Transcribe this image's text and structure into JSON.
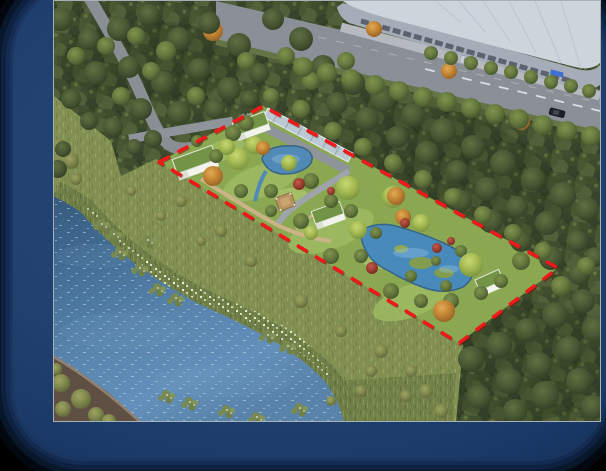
{
  "scene": {
    "description": "Aerial perspective rendering of a riverside wetland park: red dashed site boundary enclosing lawns, two ponds, four small white flat-roof buildings, a gazebo and a glass corridor; dense forest around, a river with lily pads on the lower left, and a commercial street with a large retail building and street trees at the upper right",
    "boundary": {
      "color": "#f01112",
      "style": "dashed",
      "corners": "158,161 262,105 557,267 458,342"
    },
    "colors": {
      "frame_navy": "#1f3e70",
      "background": "#000000",
      "river_water": "#527fa9",
      "pond_water": "#4286b8",
      "site_lawn": "#87a54c",
      "forest_canopy": "#2c3a20",
      "road_asphalt": "#878c94",
      "building_roof_gray": "#ccd3db",
      "park_building_white": "#f1f3ec",
      "park_building_roof_green": "#6f9040",
      "gazebo_roof_tan": "#b5905c",
      "shore_flowers": "#eef2e4"
    },
    "inventory": {
      "white_park_buildings": 4,
      "gazebo": 1,
      "ponds": 2,
      "cars_on_road": 2,
      "commercial_building": 1
    },
    "trees": {
      "forest_dark": [
        [
          60,
          18,
          12
        ],
        [
          88,
          38,
          11
        ],
        [
          118,
          28,
          12
        ],
        [
          148,
          14,
          11
        ],
        [
          178,
          38,
          12
        ],
        [
          208,
          22,
          11
        ],
        [
          238,
          44,
          12
        ],
        [
          272,
          18,
          11
        ],
        [
          300,
          38,
          12
        ],
        [
          95,
          72,
          12
        ],
        [
          70,
          98,
          10
        ],
        [
          128,
          66,
          11
        ],
        [
          162,
          82,
          12
        ],
        [
          198,
          68,
          11
        ],
        [
          228,
          88,
          12
        ],
        [
          258,
          72,
          10
        ],
        [
          140,
          108,
          11
        ],
        [
          178,
          112,
          12
        ],
        [
          214,
          108,
          10
        ],
        [
          112,
          126,
          10
        ],
        [
          88,
          120,
          9
        ],
        [
          248,
          98,
          9
        ],
        [
          152,
          138,
          9
        ],
        [
          133,
          146,
          8
        ],
        [
          57,
          168,
          9
        ],
        [
          62,
          148,
          8
        ],
        [
          322,
          66,
          12
        ],
        [
          352,
          82,
          12
        ],
        [
          382,
          98,
          13
        ],
        [
          412,
          114,
          12
        ],
        [
          442,
          130,
          13
        ],
        [
          472,
          146,
          12
        ],
        [
          502,
          162,
          13
        ],
        [
          532,
          178,
          12
        ],
        [
          562,
          194,
          13
        ],
        [
          586,
          208,
          12
        ],
        [
          336,
          102,
          11
        ],
        [
          366,
          118,
          12
        ],
        [
          396,
          136,
          11
        ],
        [
          426,
          152,
          12
        ],
        [
          456,
          170,
          11
        ],
        [
          486,
          188,
          12
        ],
        [
          516,
          206,
          11
        ],
        [
          546,
          222,
          12
        ],
        [
          576,
          240,
          11
        ],
        [
          594,
          256,
          10
        ],
        [
          460,
          200,
          11
        ],
        [
          490,
          220,
          12
        ],
        [
          520,
          240,
          11
        ],
        [
          550,
          257,
          12
        ],
        [
          578,
          273,
          11
        ],
        [
          470,
          358,
          13
        ],
        [
          498,
          344,
          13
        ],
        [
          526,
          329,
          12
        ],
        [
          554,
          314,
          13
        ],
        [
          582,
          300,
          12
        ],
        [
          594,
          328,
          13
        ],
        [
          568,
          348,
          13
        ],
        [
          538,
          364,
          13
        ],
        [
          508,
          380,
          13
        ],
        [
          478,
          396,
          12
        ],
        [
          544,
          394,
          14
        ],
        [
          578,
          380,
          13
        ],
        [
          592,
          406,
          12
        ],
        [
          514,
          410,
          12
        ]
      ],
      "forest_mid": [
        [
          75,
          55,
          9
        ],
        [
          105,
          45,
          9
        ],
        [
          165,
          50,
          10
        ],
        [
          195,
          95,
          9
        ],
        [
          245,
          60,
          9
        ],
        [
          285,
          55,
          9
        ],
        [
          120,
          95,
          9
        ],
        [
          310,
          80,
          9
        ],
        [
          345,
          60,
          9
        ],
        [
          150,
          70,
          9
        ],
        [
          135,
          35,
          9
        ],
        [
          332,
          130,
          9
        ],
        [
          362,
          146,
          9
        ],
        [
          392,
          162,
          9
        ],
        [
          422,
          178,
          9
        ],
        [
          452,
          196,
          9
        ],
        [
          482,
          214,
          9
        ],
        [
          512,
          232,
          9
        ],
        [
          542,
          250,
          9
        ],
        [
          300,
          108,
          9
        ],
        [
          270,
          95,
          8
        ],
        [
          245,
          122,
          8
        ],
        [
          560,
          285,
          10
        ],
        [
          585,
          265,
          9
        ],
        [
          520,
          260,
          9
        ]
      ],
      "site_green": [
        [
          232,
          132,
          8
        ],
        [
          270,
          190,
          7
        ],
        [
          310,
          180,
          8
        ],
        [
          330,
          200,
          7
        ],
        [
          300,
          220,
          8
        ],
        [
          330,
          255,
          8
        ],
        [
          360,
          255,
          7
        ],
        [
          390,
          290,
          8
        ],
        [
          420,
          300,
          7
        ],
        [
          450,
          300,
          8
        ],
        [
          480,
          292,
          7
        ],
        [
          270,
          210,
          6
        ],
        [
          240,
          190,
          7
        ],
        [
          215,
          155,
          7
        ],
        [
          196,
          140,
          6
        ],
        [
          350,
          210,
          7
        ],
        [
          445,
          285,
          6
        ],
        [
          500,
          280,
          7
        ],
        [
          375,
          232,
          6
        ],
        [
          410,
          275,
          6
        ],
        [
          435,
          260,
          5
        ],
        [
          460,
          250,
          6
        ]
      ],
      "willow": [
        [
          237,
          158,
          11
        ],
        [
          253,
          144,
          9
        ],
        [
          347,
          187,
          12
        ],
        [
          392,
          196,
          11
        ],
        [
          470,
          264,
          12
        ],
        [
          357,
          229,
          9
        ],
        [
          420,
          222,
          9
        ],
        [
          310,
          232,
          7
        ],
        [
          288,
          162,
          8
        ],
        [
          226,
          146,
          8
        ]
      ],
      "orange": [
        [
          212,
          30,
          10
        ],
        [
          448,
          70,
          8
        ],
        [
          373,
          28,
          8
        ],
        [
          395,
          195,
          9
        ],
        [
          212,
          175,
          10
        ],
        [
          443,
          310,
          11
        ],
        [
          402,
          216,
          8
        ],
        [
          262,
          147,
          7
        ],
        [
          520,
          120,
          9
        ]
      ],
      "red_shrub": [
        [
          298,
          183,
          6
        ],
        [
          371,
          267,
          6
        ],
        [
          436,
          247,
          5
        ],
        [
          450,
          240,
          4
        ],
        [
          404,
          222,
          5
        ],
        [
          330,
          190,
          4
        ]
      ],
      "olive_bush": [
        [
          180,
          200,
          6
        ],
        [
          220,
          230,
          6
        ],
        [
          250,
          260,
          6
        ],
        [
          300,
          300,
          7
        ],
        [
          340,
          330,
          6
        ],
        [
          380,
          350,
          7
        ],
        [
          410,
          370,
          6
        ],
        [
          200,
          240,
          5
        ],
        [
          160,
          215,
          5
        ],
        [
          130,
          190,
          5
        ],
        [
          425,
          390,
          7
        ],
        [
          440,
          410,
          7
        ],
        [
          405,
          395,
          6
        ],
        [
          370,
          370,
          6
        ],
        [
          360,
          390,
          6
        ],
        [
          330,
          400,
          5
        ],
        [
          60,
          382,
          9
        ],
        [
          80,
          398,
          10
        ],
        [
          62,
          408,
          8
        ],
        [
          95,
          414,
          8
        ],
        [
          108,
          420,
          7
        ],
        [
          55,
          368,
          6
        ],
        [
          70,
          160,
          8
        ],
        [
          58,
          145,
          7
        ],
        [
          75,
          178,
          6
        ]
      ],
      "street": [
        [
          430,
          52,
          7
        ],
        [
          450,
          57,
          7
        ],
        [
          470,
          62,
          7
        ],
        [
          490,
          67,
          7
        ],
        [
          510,
          71,
          7
        ],
        [
          530,
          76,
          7
        ],
        [
          550,
          81,
          7
        ],
        [
          570,
          85,
          7
        ],
        [
          588,
          90,
          7
        ],
        [
          350,
          78,
          10
        ],
        [
          374,
          84,
          10
        ],
        [
          398,
          90,
          10
        ],
        [
          422,
          96,
          10
        ],
        [
          446,
          101,
          10
        ],
        [
          470,
          107,
          10
        ],
        [
          494,
          113,
          10
        ],
        [
          518,
          118,
          10
        ],
        [
          542,
          124,
          10
        ],
        [
          566,
          130,
          10
        ],
        [
          590,
          135,
          10
        ],
        [
          326,
          72,
          10
        ],
        [
          302,
          66,
          10
        ]
      ]
    },
    "lilies": [
      [
        118,
        250
      ],
      [
        138,
        266
      ],
      [
        156,
        286
      ],
      [
        174,
        296
      ],
      [
        146,
        238
      ],
      [
        266,
        333
      ],
      [
        286,
        344
      ],
      [
        165,
        393
      ],
      [
        188,
        400
      ],
      [
        225,
        408
      ],
      [
        255,
        415
      ],
      [
        298,
        406
      ],
      [
        100,
        222
      ],
      [
        112,
        232
      ]
    ]
  }
}
